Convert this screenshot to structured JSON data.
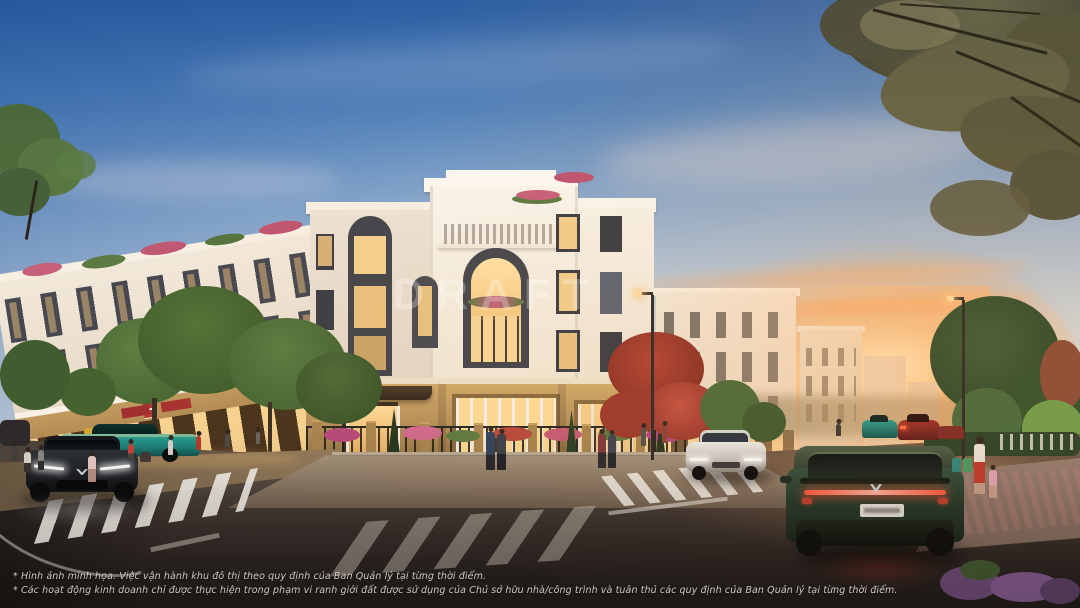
{
  "scene": {
    "watermark": "DRAFT",
    "disclaimer": {
      "line1": "* Hình ảnh minh họa. Việc vận hành khu đô thị theo quy định của Ban Quản lý tại từng thời điểm.",
      "line2": "* Các hoạt động kinh doanh chỉ được thực hiện trong phạm vi ranh giới đất được sử dụng của Chủ sở hữu nhà/công trình và tuân thủ các quy định của Ban Quản lý tại từng thời điểm."
    },
    "colors": {
      "sky_top": "#2d62a9",
      "sky_pale": "#e4e6e2",
      "sunset_glow": "#ffb35c",
      "facade_white": "#f7f1e6",
      "facade_gold": "#c09a5c",
      "window_dark": "#44454b",
      "window_lit": "#f8d694",
      "road_dark": "#241f1d",
      "suv_green": "#2c4a33",
      "suv_gray": "#2f3237",
      "sedan_teal": "#27a193",
      "suv_white": "#e8e6e2",
      "tail_light_red": "#ff5a3c"
    }
  }
}
